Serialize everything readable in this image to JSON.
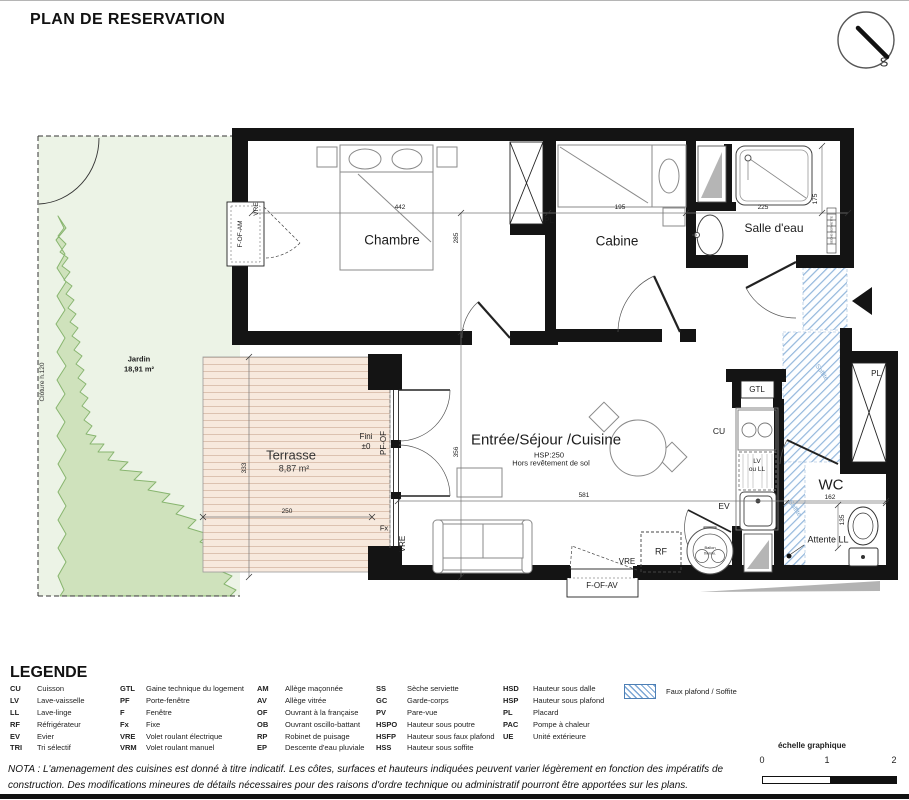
{
  "title": "PLAN DE RESERVATION",
  "compass": {
    "s": "S"
  },
  "colors": {
    "wall": "#141414",
    "garden": "#ecf3e6",
    "hedge": "#cfe2bc",
    "terrace": "#f7e9dd",
    "soffit_blue": "#8fb4da"
  },
  "labels": {
    "chambre": "Chambre",
    "cabine": "Cabine",
    "salle_deau": "Salle d'eau",
    "sejour": "Entrée/Séjour /Cuisine",
    "wc": "WC",
    "jardin": "Jardin",
    "jardin_area": "18,91 m²",
    "terrasse": "Terrasse",
    "terrasse_area": "8,87 m²"
  },
  "ann": {
    "hsp": "HSP:250",
    "hors": "Hors revêtement de sol",
    "fini": "Fini",
    "fini0": "±0",
    "attente": "Attente LL",
    "cloture": "Clôture h.120",
    "soffite": "Soffite",
    "seche": "SECHE-SERVIETTE",
    "ballon1": "Ballon",
    "ballon2": "thermo."
  },
  "dims": {
    "w442": "442",
    "h285": "285",
    "w195": "195",
    "w225": "225",
    "h175": "175",
    "w581": "581",
    "h356": "356",
    "h333": "333",
    "w250": "250",
    "w162": "162",
    "h135": "135"
  },
  "tags": {
    "f_of_am": "F-OF-AM",
    "vre": "VRE",
    "pl": "PL",
    "gtl": "GTL",
    "cu": "CU",
    "ev": "EV",
    "lv": "LV",
    "lv2": "ou LL",
    "rf": "RF",
    "fx": "Fx",
    "pf_of": "PF-OF",
    "f_of_av": "F-OF-AV"
  },
  "legend": {
    "heading": "LEGENDE",
    "soffit_swatch": "Faux plafond / Soffite",
    "c1": [
      {
        "a": "CU",
        "l": "Cuisson"
      },
      {
        "a": "LV",
        "l": "Lave-vaisselle"
      },
      {
        "a": "LL",
        "l": "Lave-linge"
      },
      {
        "a": "RF",
        "l": "Réfrigérateur"
      },
      {
        "a": "EV",
        "l": "Evier"
      },
      {
        "a": "TRI",
        "l": "Tri sélectif"
      }
    ],
    "c2": [
      {
        "a": "GTL",
        "l": "Gaine technique du logement"
      },
      {
        "a": "PF",
        "l": "Porte-fenêtre"
      },
      {
        "a": "F",
        "l": "Fenêtre"
      },
      {
        "a": "Fx",
        "l": "Fixe"
      },
      {
        "a": "VRE",
        "l": "Volet roulant électrique"
      },
      {
        "a": "VRM",
        "l": "Volet roulant manuel"
      }
    ],
    "c3": [
      {
        "a": "AM",
        "l": "Allège maçonnée"
      },
      {
        "a": "AV",
        "l": "Allège vitrée"
      },
      {
        "a": "OF",
        "l": "Ouvrant à la française"
      },
      {
        "a": "OB",
        "l": "Ouvrant oscillo-battant"
      },
      {
        "a": "RP",
        "l": "Robinet de puisage"
      },
      {
        "a": "EP",
        "l": "Descente d'eau pluviale"
      }
    ],
    "c4": [
      {
        "a": "SS",
        "l": "Sèche serviette"
      },
      {
        "a": "GC",
        "l": "Garde-corps"
      },
      {
        "a": "PV",
        "l": "Pare-vue"
      },
      {
        "a": "HSPO",
        "l": "Hauteur sous poutre"
      },
      {
        "a": "HSFP",
        "l": "Hauteur sous faux plafond"
      },
      {
        "a": "HSS",
        "l": "Hauteur sous soffite"
      }
    ],
    "c5": [
      {
        "a": "HSD",
        "l": "Hauteur sous dalle"
      },
      {
        "a": "HSP",
        "l": "Hauteur sous plafond"
      },
      {
        "a": "PL",
        "l": "Placard"
      },
      {
        "a": "PAC",
        "l": "Pompe à chaleur"
      },
      {
        "a": "UE",
        "l": "Unité extérieure"
      }
    ]
  },
  "scale": {
    "title": "échelle graphique",
    "t0": "0",
    "t1": "1",
    "t2": "2"
  },
  "nota": {
    "l1": "NOTA : L'amenagement des cuisines est donné à titre indicatif. Les côtes, surfaces et hauteurs indiquées peuvent varier légèrement en fonction des impératifs de",
    "l2": "construction. Des modifications mineures de détails nécessaires pour des raisons d'ordre technique ou administratif pourront être apportées sur les plans."
  }
}
